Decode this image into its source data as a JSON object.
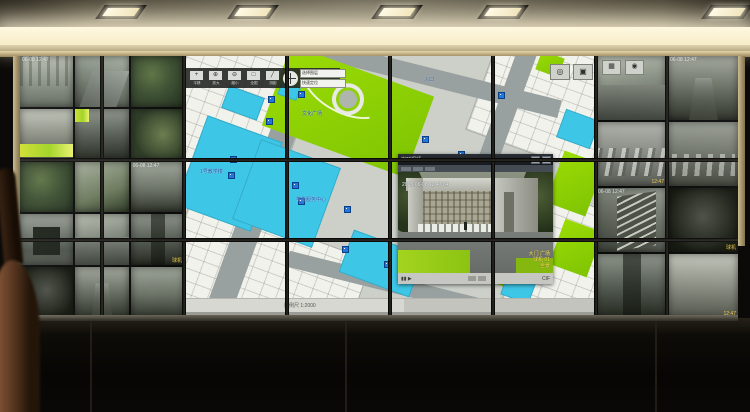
{
  "room": {
    "ceiling_fixtures": [
      {
        "x": 100
      },
      {
        "x": 232
      },
      {
        "x": 376
      },
      {
        "x": 482
      },
      {
        "x": 706
      }
    ]
  },
  "map_app": {
    "toolbar": {
      "buttons": [
        {
          "name": "pan-tool",
          "glyph": "+",
          "label": "平移"
        },
        {
          "name": "zoom-in-tool",
          "glyph": "⊕",
          "label": "放大"
        },
        {
          "name": "zoom-out-tool",
          "glyph": "⊖",
          "label": "缩小"
        },
        {
          "name": "full-extent-tool",
          "glyph": "□",
          "label": "全图"
        },
        {
          "name": "measure-tool",
          "glyph": "╱",
          "label": "测距"
        }
      ],
      "readouts": [
        {
          "text": "选择图层"
        },
        {
          "text": "快速定位"
        }
      ]
    },
    "topright_buttons": [
      {
        "name": "pan-mode-button",
        "glyph": "◎"
      },
      {
        "name": "grid-view-button",
        "glyph": "▣"
      }
    ],
    "labels": [
      {
        "text": "文化广场",
        "x": 118,
        "y": 54
      },
      {
        "text": "学生服务中心",
        "x": 112,
        "y": 140
      },
      {
        "text": "入口",
        "x": 240,
        "y": 20
      },
      {
        "text": "1号教学楼",
        "x": 16,
        "y": 112
      },
      {
        "text": "图书馆",
        "x": 296,
        "y": 128
      }
    ],
    "camera_markers": [
      {
        "x": 84,
        "y": 40
      },
      {
        "x": 114,
        "y": 35
      },
      {
        "x": 82,
        "y": 62
      },
      {
        "x": 46,
        "y": 100
      },
      {
        "x": 44,
        "y": 116
      },
      {
        "x": 108,
        "y": 126
      },
      {
        "x": 114,
        "y": 142
      },
      {
        "x": 160,
        "y": 150
      },
      {
        "x": 238,
        "y": 80
      },
      {
        "x": 274,
        "y": 95
      },
      {
        "x": 244,
        "y": 130
      },
      {
        "x": 280,
        "y": 132
      },
      {
        "x": 158,
        "y": 190
      },
      {
        "x": 284,
        "y": 190
      },
      {
        "x": 314,
        "y": 36
      },
      {
        "x": 200,
        "y": 205
      }
    ],
    "status_bar": {
      "scale_text": "比例尺 1:2000"
    }
  },
  "popup": {
    "title": "实时视频",
    "maximize_glyph": "□",
    "close_glyph": "×",
    "timestamp": "2015-06-08 12:47:04",
    "info_lines": [
      {
        "text": "大门 广场"
      },
      {
        "text": "球机 01"
      },
      {
        "text": "全景"
      }
    ],
    "bottom_bar": {
      "left_text": "▮▮ ▶",
      "right_text": "CIF"
    }
  },
  "right_monitor_toolbar": [
    {
      "name": "matrix-view-icon",
      "glyph": "▦"
    },
    {
      "name": "record-icon",
      "glyph": "◉"
    }
  ],
  "cameras_left": [
    {
      "id": "L01",
      "variant": "v-facade",
      "tl": "06-08 12:47"
    },
    {
      "id": "L02",
      "variant": "v-street",
      "tl": ""
    },
    {
      "id": "L03",
      "variant": "v-foliage"
    },
    {
      "id": "L04",
      "variant": "v-facade2",
      "banner": true,
      "br": "2015-06-08"
    },
    {
      "id": "L05",
      "variant": "v-alley",
      "banner": true
    },
    {
      "id": "L06",
      "variant": "v-foliage2"
    },
    {
      "id": "L07",
      "variant": "v-foliage"
    },
    {
      "id": "L08",
      "variant": "v-courtyard"
    },
    {
      "id": "L09",
      "variant": "v-alley2",
      "tl": "06-08 12:47"
    },
    {
      "id": "L10",
      "variant": "v-gate"
    },
    {
      "id": "L11",
      "variant": "v-street2"
    },
    {
      "id": "L12",
      "variant": "v-alley",
      "br": "球机"
    },
    {
      "id": "L13",
      "variant": "v-dark"
    },
    {
      "id": "L14",
      "variant": "v-lane"
    },
    {
      "id": "L15",
      "variant": "v-alley2"
    }
  ],
  "cameras_right": [
    {
      "id": "R01",
      "variant": "v-street2",
      "tl": ""
    },
    {
      "id": "R02",
      "variant": "v-lane",
      "tl": "06-08 12:47"
    },
    {
      "id": "R03",
      "variant": "v-parking",
      "br": "12:47"
    },
    {
      "id": "R04",
      "variant": "v-parking2"
    },
    {
      "id": "R05",
      "variant": "v-stairs",
      "tl": "06-08 12:47"
    },
    {
      "id": "R06",
      "variant": "v-dark",
      "br": "球机"
    },
    {
      "id": "R07",
      "variant": "v-alley"
    },
    {
      "id": "R08",
      "variant": "v-facade2",
      "br": "12:47"
    }
  ]
}
